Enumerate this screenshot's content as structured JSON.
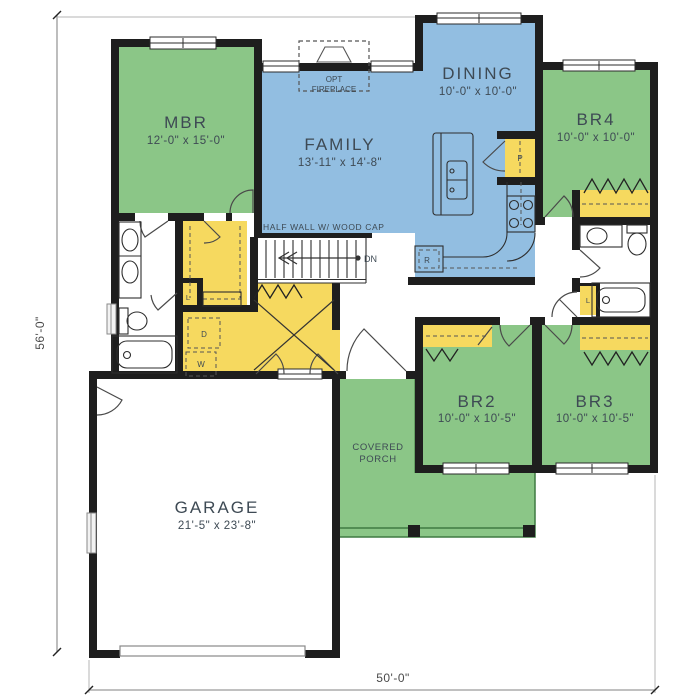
{
  "title": "House first-floor plan",
  "colors": {
    "bedroom_green": "#8bc687",
    "living_blue": "#92bee1",
    "closet_yellow": "#f6d95f",
    "wall_black": "#1e1e1e",
    "label_text": "#3e4a54",
    "dimension_text": "#4a4a4a",
    "porch_edge": "#3f7a42"
  },
  "rooms": {
    "mbr": {
      "name": "MBR",
      "dims": "12'-0\" x 15'-0\""
    },
    "family": {
      "name": "FAMILY",
      "dims": "13'-11\" x 14'-8\""
    },
    "dining": {
      "name": "DINING",
      "dims": "10'-0\" x 10'-0\""
    },
    "br4": {
      "name": "BR4",
      "dims": "10'-0\" x 10'-0\""
    },
    "br2": {
      "name": "BR2",
      "dims": "10'-0\" x 10'-5\""
    },
    "br3": {
      "name": "BR3",
      "dims": "10'-0\" x 10'-5\""
    },
    "garage": {
      "name": "GARAGE",
      "dims": "21'-5\" x 23'-8\""
    },
    "porch": {
      "line1": "COVERED",
      "line2": "PORCH"
    }
  },
  "annotations": {
    "half_wall": "HALF WALL W/ WOOD CAP",
    "fireplace_line1": "OPT",
    "fireplace_line2": "FIREPLACE",
    "stairs_direction": "DN"
  },
  "fixtures": {
    "pantry": "P",
    "refrigerator": "R",
    "linen_master": "L",
    "linen_hall": "L",
    "dryer": "D",
    "washer": "W"
  },
  "dimensions": {
    "overall_depth": "56'-0\"",
    "overall_width": "50'-0\""
  }
}
